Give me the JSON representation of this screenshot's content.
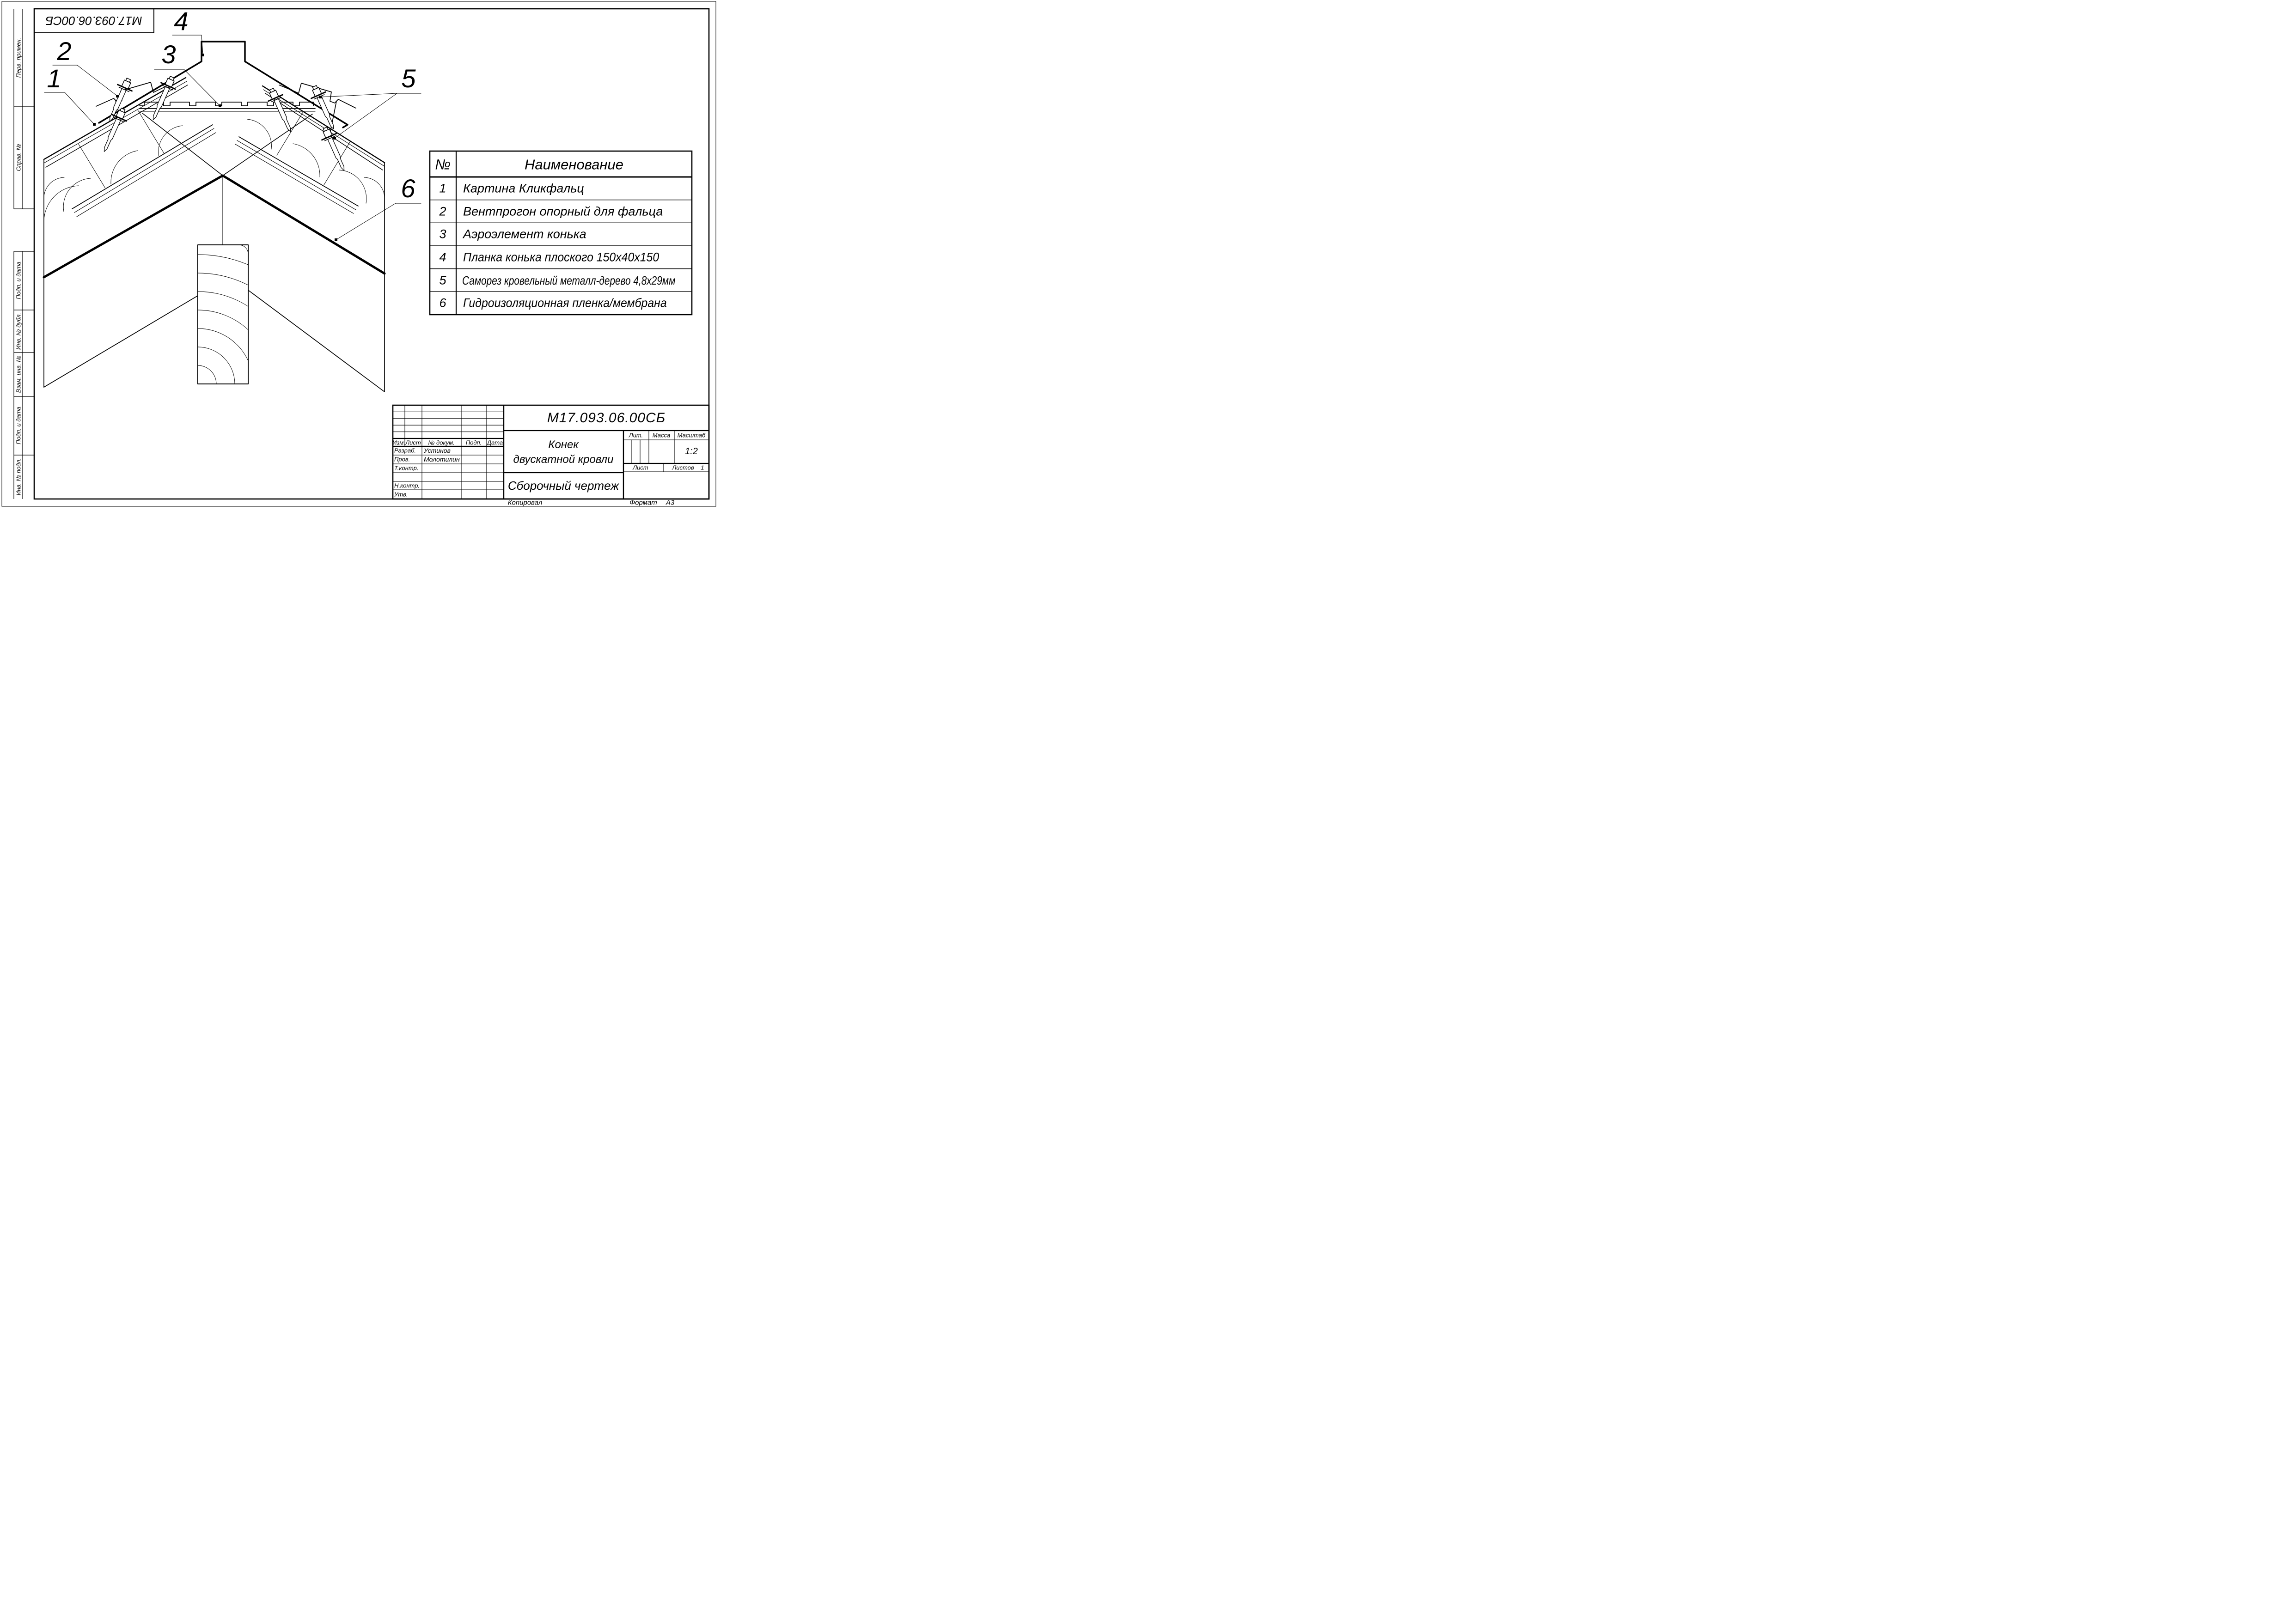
{
  "colors": {
    "ink": "#000000",
    "paper": "#ffffff"
  },
  "stamp": {
    "code": "М17.093.06.00СБ"
  },
  "margin_labels": {
    "perv_primen": "Перв. примен.",
    "sprav_no": "Справ. №",
    "podp_i_data_1": "Подп. и дата",
    "inv_no_dubl": "Инв. № дубл.",
    "vzam_inv_no": "Взам. инв. №",
    "podp_i_data_2": "Подп. и дата",
    "inv_no_podl": "Инв. № подл."
  },
  "callouts": {
    "c1": "1",
    "c2": "2",
    "c3": "3",
    "c4": "4",
    "c5": "5",
    "c6": "6"
  },
  "parts_table": {
    "headers": {
      "no": "№",
      "name": "Наименование"
    },
    "rows": [
      {
        "no": "1",
        "name": "Картина Кликфальц"
      },
      {
        "no": "2",
        "name": "Вентпрогон опорный для фальца"
      },
      {
        "no": "3",
        "name": "Аэроэлемент конька"
      },
      {
        "no": "4",
        "name": "Планка конька плоского 150х40х150"
      },
      {
        "no": "5",
        "name": "Саморез кровельный металл-дерево 4,8х29мм"
      },
      {
        "no": "6",
        "name": "Гидроизоляционная пленка/мембрана"
      }
    ]
  },
  "title_block": {
    "designation": "М17.093.06.00СБ",
    "title_line1": "Конек",
    "title_line2": "двускатной кровли",
    "doc_type": "Сборочный чертеж",
    "headers": {
      "izm": "Изм.",
      "list": "Лист",
      "no_dokum": "№ докум.",
      "podp": "Подп.",
      "data": "Дата",
      "lit": "Лит.",
      "massa": "Масса",
      "masshtab": "Масштаб",
      "list2": "Лист",
      "listov": "Листов"
    },
    "rows": {
      "razrab_label": "Разраб.",
      "razrab_value": "Устинов",
      "prov_label": "Пров.",
      "prov_value": "Молотилин",
      "tkontr_label": "Т.контр.",
      "nkontr_label": "Н.контр.",
      "utv_label": "Утв."
    },
    "scale_value": "1:2",
    "listov_value": "1"
  },
  "footer": {
    "copied": "Копировал",
    "format_label": "Формат",
    "format_value": "А3"
  }
}
